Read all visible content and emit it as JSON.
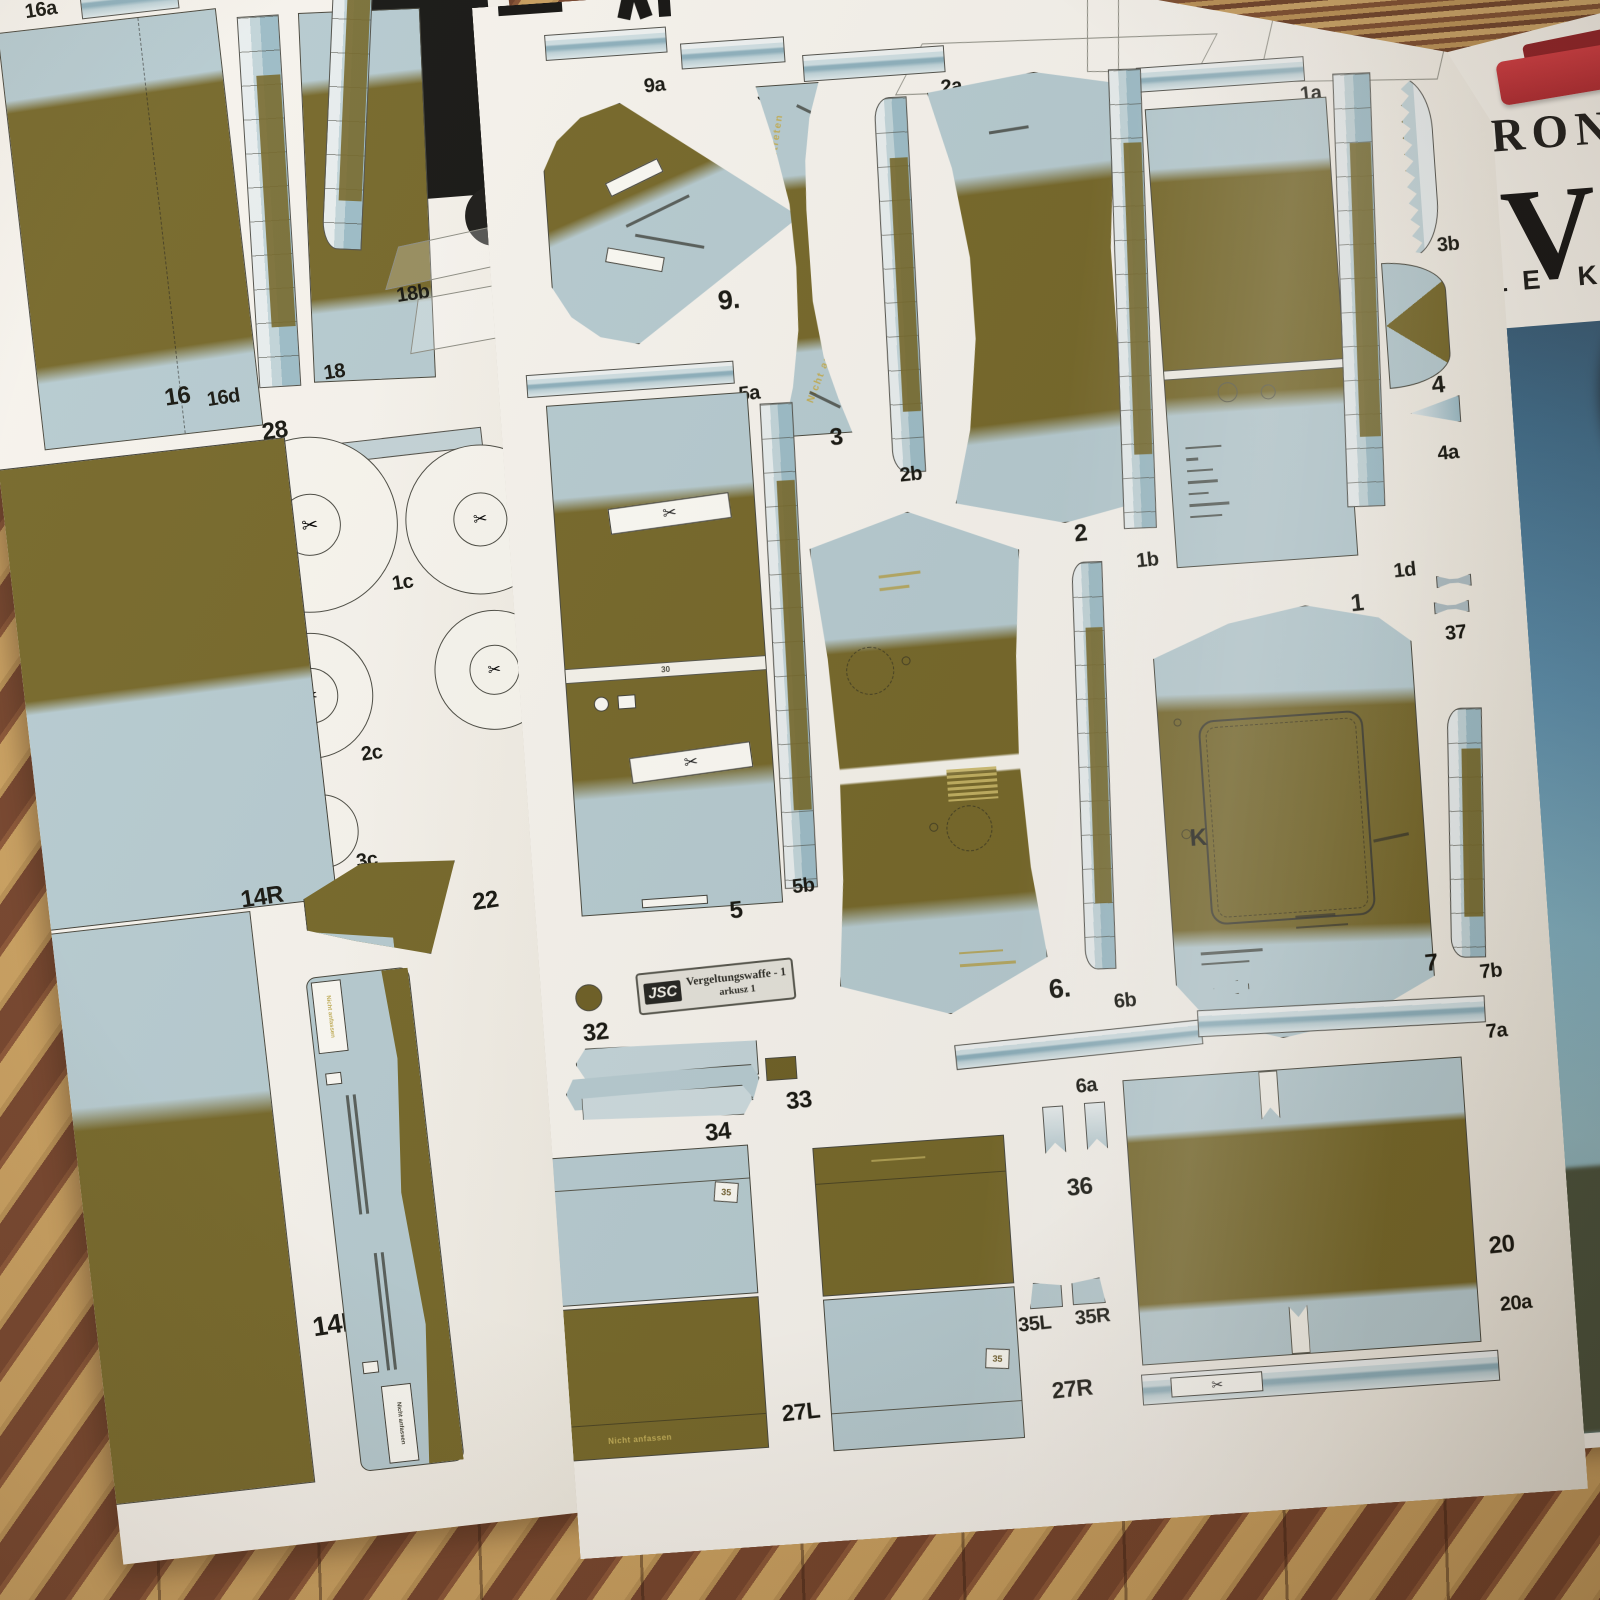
{
  "icons": {
    "scissors": "✂"
  },
  "main_sheet": {
    "plate": {
      "brand": "JSC",
      "title": "Vergeltungswaffe - 1",
      "subtitle": "arkusz 1"
    },
    "part_labels": [
      "9a",
      "3a",
      "2a",
      "9.",
      "3",
      "2b",
      "2",
      "1a",
      "1b",
      "1",
      "1d",
      "3b",
      "4",
      "4a",
      "37",
      "5a",
      "5",
      "5b",
      "6.",
      "6a",
      "6b",
      "7",
      "7a",
      "7b",
      "20",
      "20a",
      "27L",
      "27R",
      "32",
      "33",
      "34",
      "35L",
      "35R",
      "36"
    ],
    "markings": {
      "nicht_auftreten": "Nicht auftreten",
      "k": "K",
      "strip_30": "30",
      "tag_35": "35"
    }
  },
  "left_sheet": {
    "part_labels": [
      "16a",
      "18a",
      "18b",
      "18",
      "16",
      "16d",
      "28",
      "1c",
      "2c",
      "3c",
      "14R",
      "22",
      "14L"
    ],
    "markings": {
      "nicht_anfassen": "Nicht anfassen"
    }
  },
  "poster": {
    "heading": "BRON",
    "big_letter": "V",
    "subheading": "ELE KA"
  }
}
